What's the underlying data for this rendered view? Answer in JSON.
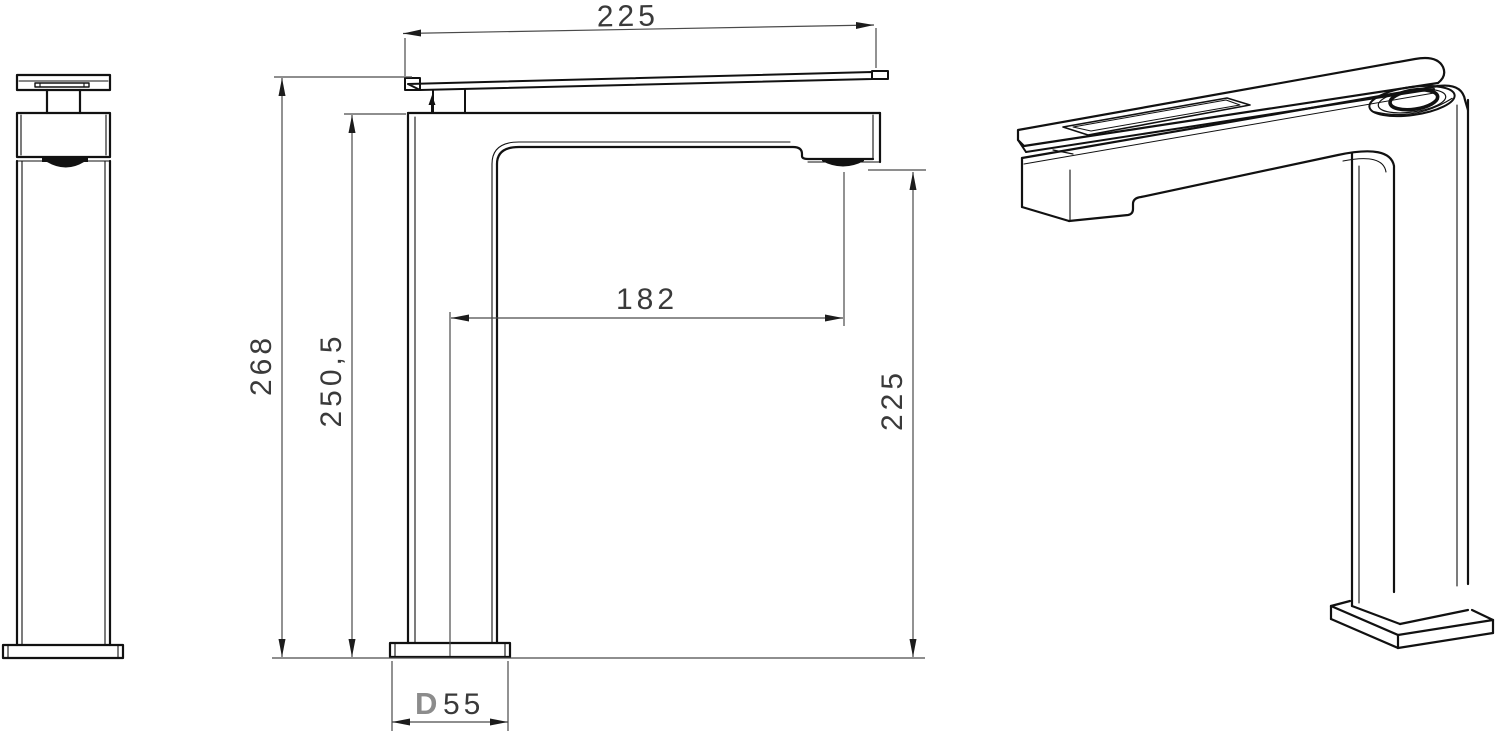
{
  "drawing": {
    "title": "faucet-technical-drawing",
    "dimensions": {
      "spout_width": "225",
      "total_height": "268",
      "height_to_body_top": "250,5",
      "spout_reach": "182",
      "outlet_height": "225",
      "base_prefix": "D",
      "base_size": "55"
    },
    "colors": {
      "line": "#111111",
      "dimension": "#4a4a4a",
      "text": "#3a3a3a",
      "base_letter": "#8c8c8c",
      "background": "#ffffff"
    }
  }
}
